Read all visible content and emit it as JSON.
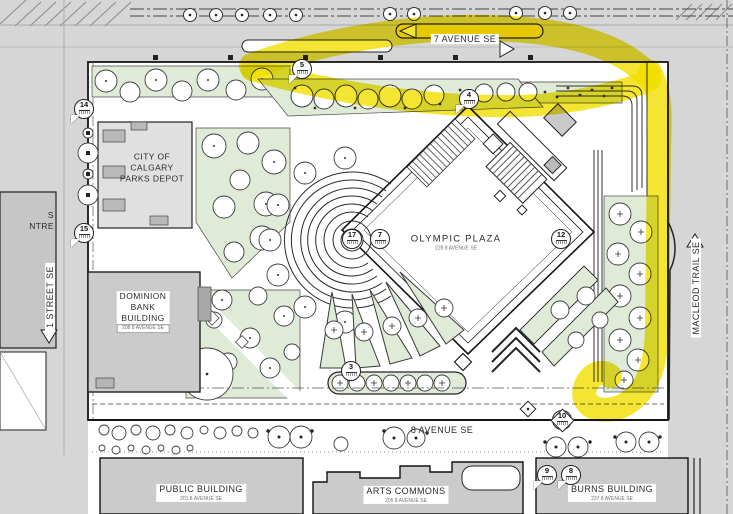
{
  "map": {
    "title": "Olympic Plaza site plan",
    "streets": {
      "seven_avenue": "7 AVENUE SE",
      "eight_avenue": "8 AVENUE SE",
      "first_street": "1 STREET SE",
      "macleod_trail": "MACLEOD TRAIL SE"
    },
    "plaza": {
      "name": "OLYMPIC PLAZA",
      "address": "228 8 AVENUE SE"
    },
    "buildings": {
      "parks_depot": {
        "line1": "CITY OF",
        "line2": "CALGARY",
        "line3": "PARKS DEPOT"
      },
      "dominion_bank": {
        "line1": "DOMINION",
        "line2": "BANK",
        "line3": "BUILDING",
        "address": "208 8 AVENUE SE"
      },
      "public_building": {
        "name": "PUBLIC BUILDING",
        "address": "201 8 AVENUE SE"
      },
      "arts_commons": {
        "name": "ARTS COMMONS",
        "address": "205 8 AVENUE SE"
      },
      "burns_building": {
        "name": "BURNS BUILDING",
        "address": "237 8 AVENUE SE"
      },
      "west_building_partial": {
        "line1": "S",
        "line2": "NTRE"
      }
    },
    "callouts": {
      "c3": "3",
      "c4": "4",
      "c5": "5",
      "c7": "7",
      "c8": "8",
      "c9": "9",
      "c10": "10",
      "c12": "12",
      "c14": "14",
      "c15": "15",
      "c17": "17"
    },
    "colors": {
      "street": "#d6d6d6",
      "building": "#cbcbcb",
      "green": "#dfead7",
      "highlight": "#f1df00"
    }
  }
}
